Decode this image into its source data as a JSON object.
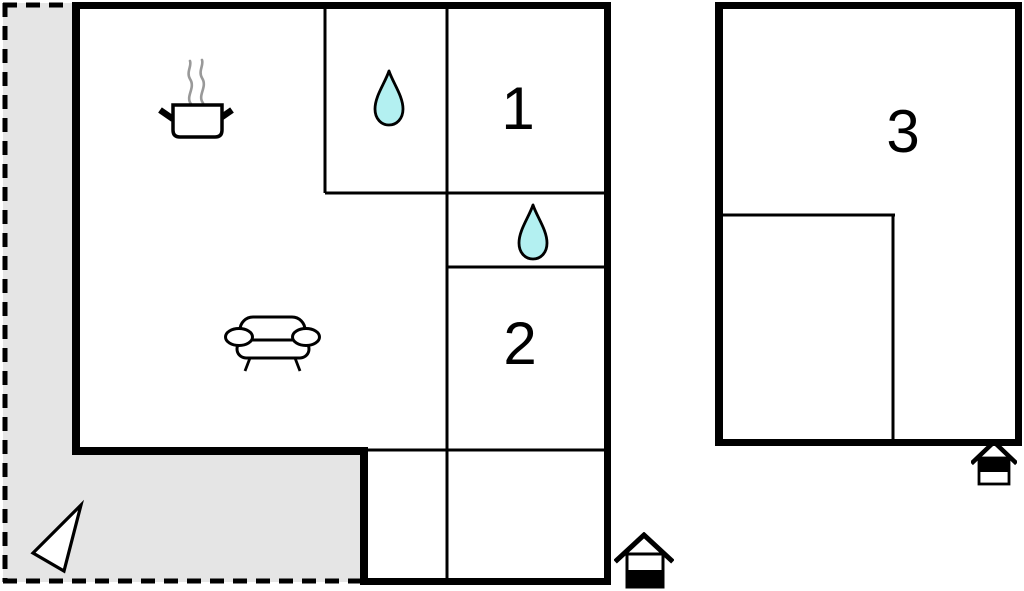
{
  "plan": {
    "type": "holiday-home-floor-plan",
    "colors": {
      "wall": "#000000",
      "terrace_fill": "#e5e5e5",
      "water_drop_fill": "#b3f0f1",
      "steam": "#999999",
      "background": "#ffffff",
      "icon_fill": "#ffffff"
    },
    "rooms": {
      "room1": {
        "label": "1"
      },
      "room2": {
        "label": "2"
      },
      "room3": {
        "label": "3"
      }
    },
    "icons": {
      "stove": "cooking-pot-with-steam",
      "sofa": "sofa-front-view",
      "bathroom_drop": "water-drop",
      "wc_drop": "water-drop",
      "main_floor_marker": "house-lower-level-marker",
      "annex_floor_marker": "house-upper-level-marker",
      "direction_arrow": "triangle-pointer"
    }
  }
}
